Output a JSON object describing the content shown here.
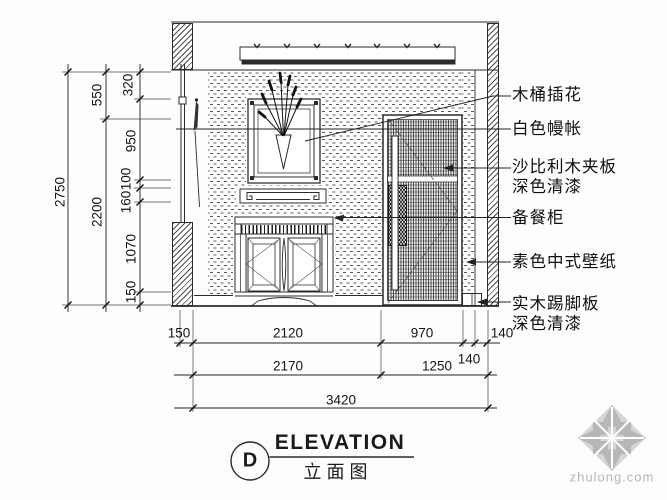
{
  "drawing": {
    "kind": "interior elevation CAD drawing",
    "colors": {
      "line": "#2b2b2b",
      "watermark": "#b5b5b5"
    },
    "callouts": {
      "flower": "木桶插花",
      "curtain": "白色幔帐",
      "sapele1": "沙比利木夹板",
      "sapele2": "深色清漆",
      "cabinet": "备餐柜",
      "wallpaper": "素色中式壁纸",
      "skirting1": "实木踢脚板",
      "skirting2": "深色清漆"
    },
    "dims": {
      "vertical": {
        "total": "2750",
        "upper": "550",
        "lower": "2200",
        "seg320": "320",
        "seg950": "950",
        "seg100": "100",
        "seg160": "160",
        "seg1070": "1070",
        "seg150": "150"
      },
      "row1": {
        "d150": "150",
        "d2120": "2120",
        "d970": "970",
        "d140": "140"
      },
      "row2": {
        "d2170": "2170",
        "d1250": "1250",
        "d140": "140"
      },
      "row3": {
        "d3420": "3420"
      }
    },
    "title": {
      "bubble": "D",
      "en": "ELEVATION",
      "cn": "立面图"
    },
    "watermark": {
      "text": "zhulong.com"
    }
  }
}
